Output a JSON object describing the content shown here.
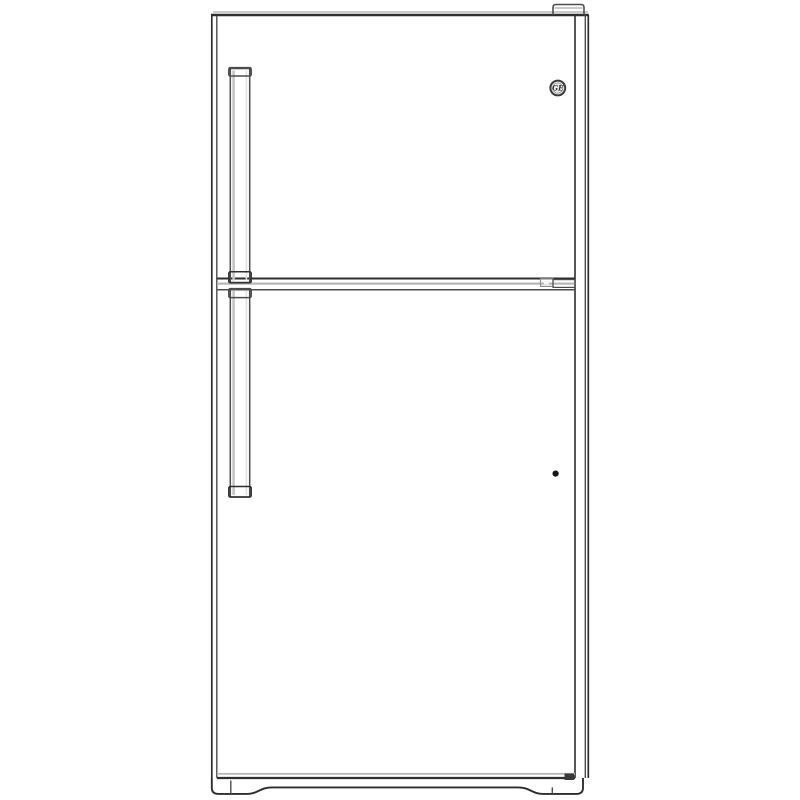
{
  "product_image": {
    "description": "Black-and-white line drawing of a GE top-freezer refrigerator, front view, on a plain white background",
    "brand_logo_text": "GE"
  },
  "colors": {
    "bg": "#ffffff",
    "line": "#2e2e2e",
    "line-mid": "#4c4c4c",
    "line-soft": "#8f8f8f",
    "shade": "#b8b8b8",
    "cap-fill": "#c9c9c9",
    "panel-fill": "#ffffff",
    "dot": "#161616",
    "hinge-bar": "#9a9a9a"
  }
}
